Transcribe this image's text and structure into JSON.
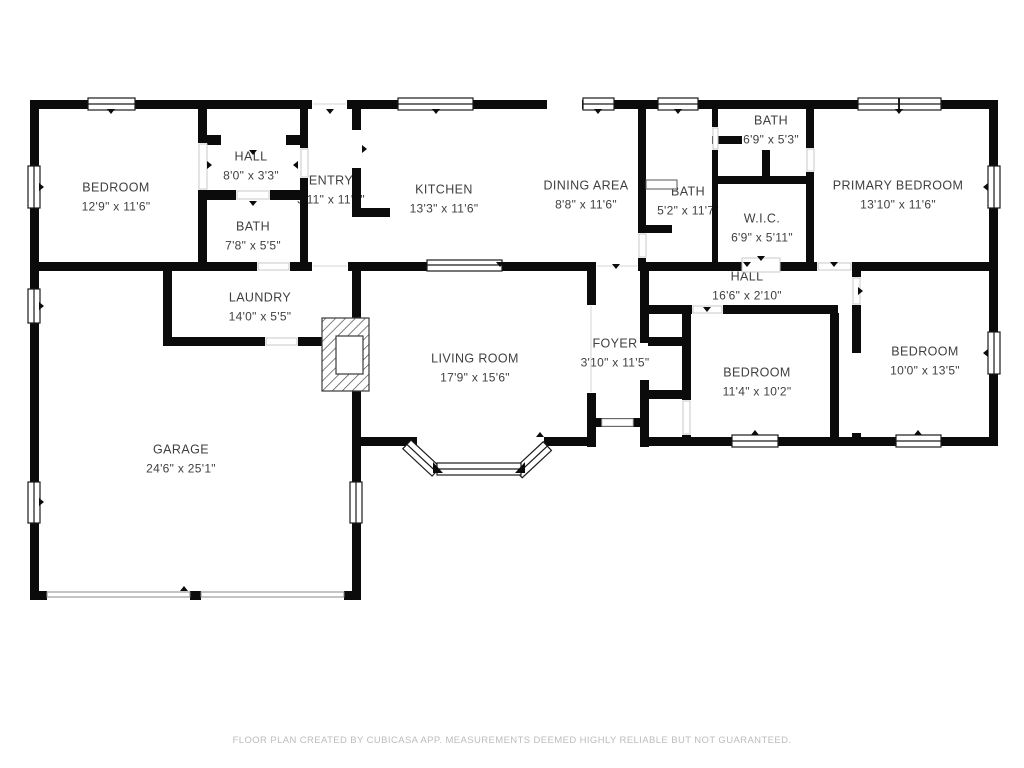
{
  "meta": {
    "footer": "FLOOR PLAN CREATED BY CUBICASA APP. MEASUREMENTS DEEMED HIGHLY RELIABLE BUT NOT GUARANTEED.",
    "wall_color": "#0b0b0b",
    "label_color": "#3f3f3f",
    "footer_color": "#bcbcbc"
  },
  "rooms": [
    {
      "id": "bedroom-top-left",
      "name": "BEDROOM",
      "dims": "12'9\" x 11'6\""
    },
    {
      "id": "hall-top",
      "name": "HALL",
      "dims": "8'0\" x 3'3\""
    },
    {
      "id": "bath-top-left",
      "name": "BATH",
      "dims": "7'8\" x 5'5\""
    },
    {
      "id": "entry",
      "name": "ENTRY",
      "dims": "3'11\" x 11'6\""
    },
    {
      "id": "kitchen",
      "name": "KITCHEN",
      "dims": "13'3\" x 11'6\""
    },
    {
      "id": "dining-area",
      "name": "DINING AREA",
      "dims": "8'8\" x 11'6\""
    },
    {
      "id": "bath-top-right",
      "name": "BATH",
      "dims": "6'9\" x 5'3\""
    },
    {
      "id": "bath-middle",
      "name": "BATH",
      "dims": "5'2\" x 11'7\""
    },
    {
      "id": "wic",
      "name": "W.I.C.",
      "dims": "6'9\" x 5'11\""
    },
    {
      "id": "primary-bedroom",
      "name": "PRIMARY BEDROOM",
      "dims": "13'10\" x 11'6\""
    },
    {
      "id": "hall-middle",
      "name": "HALL",
      "dims": "16'6\" x 2'10\""
    },
    {
      "id": "laundry",
      "name": "LAUNDRY",
      "dims": "14'0\" x 5'5\""
    },
    {
      "id": "living-room",
      "name": "LIVING ROOM",
      "dims": "17'9\" x 15'6\""
    },
    {
      "id": "foyer",
      "name": "FOYER",
      "dims": "3'10\" x 11'5\""
    },
    {
      "id": "bedroom-middle",
      "name": "BEDROOM",
      "dims": "11'4\" x 10'2\""
    },
    {
      "id": "bedroom-right",
      "name": "BEDROOM",
      "dims": "10'0\" x 13'5\""
    },
    {
      "id": "garage",
      "name": "GARAGE",
      "dims": "24'6\" x 25'1\""
    }
  ]
}
